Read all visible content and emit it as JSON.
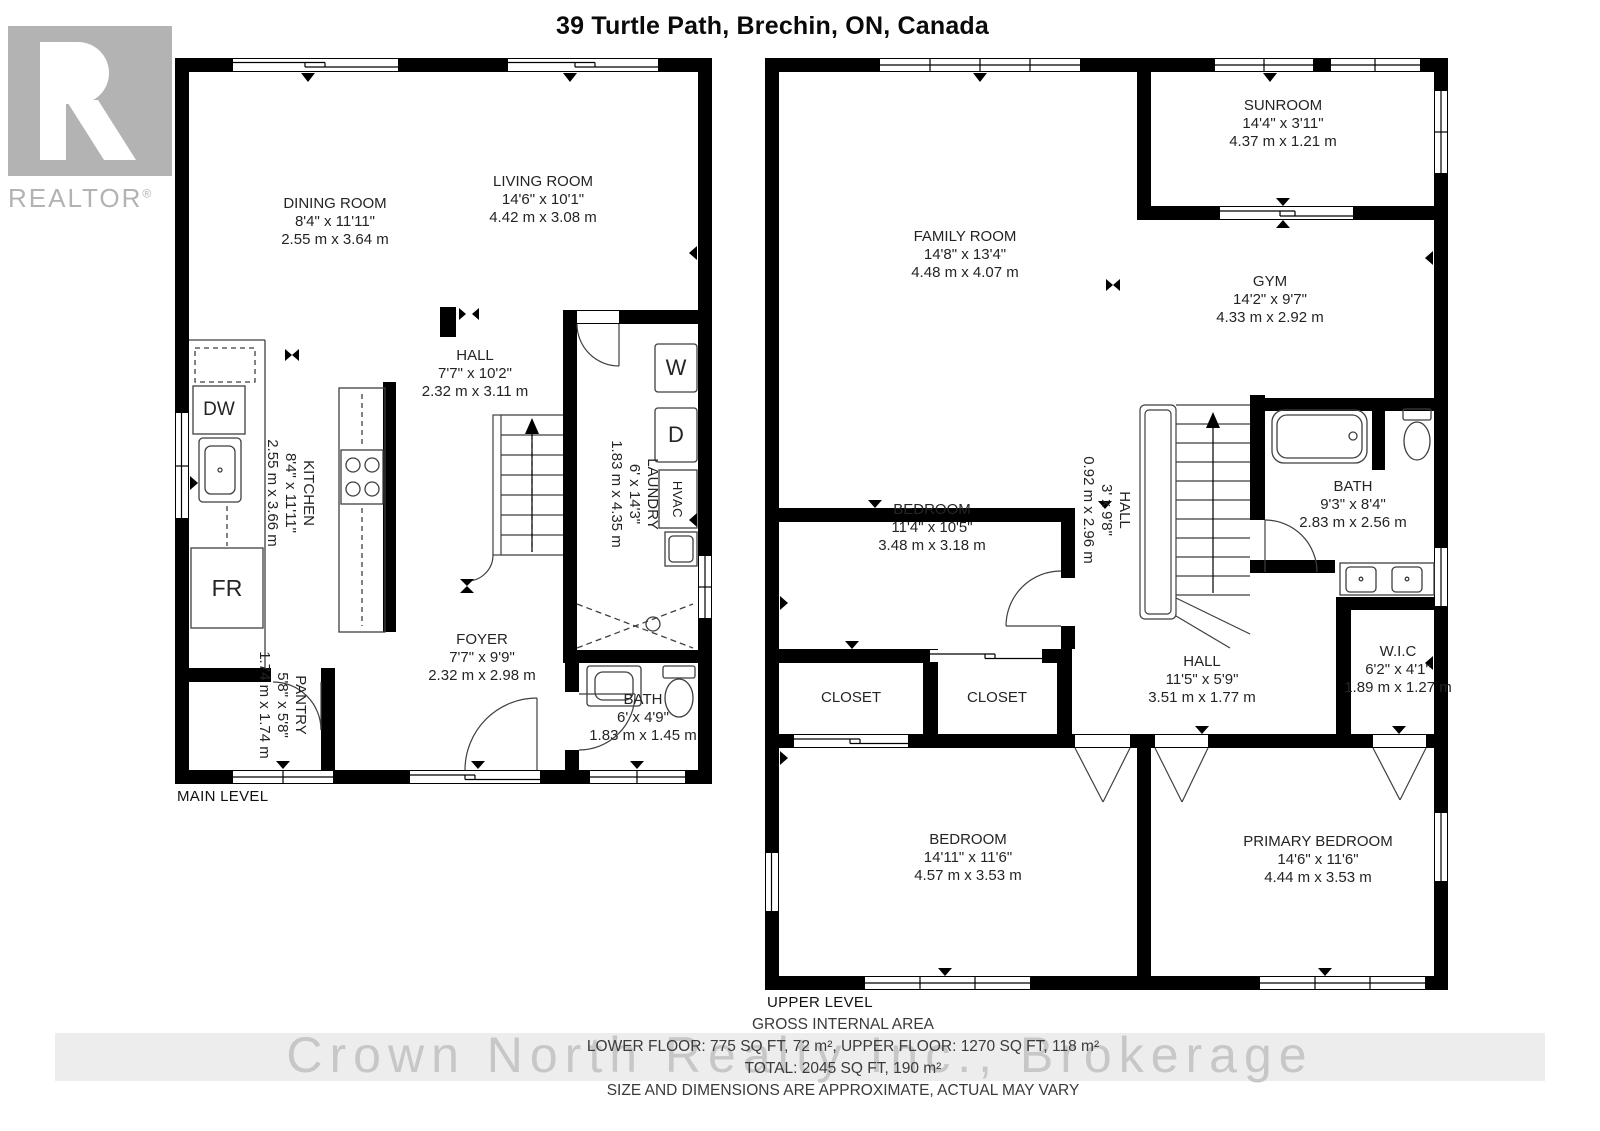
{
  "title": "39 Turtle Path, Brechin, ON, Canada",
  "logo": {
    "text": "REALTOR",
    "reg": "®"
  },
  "main": {
    "label": "MAIN LEVEL",
    "rooms": {
      "dining": {
        "name": "DINING ROOM",
        "imperial": "8'4\" x 11'11\"",
        "metric": "2.55 m x 3.64 m"
      },
      "living": {
        "name": "LIVING ROOM",
        "imperial": "14'6\" x 10'1\"",
        "metric": "4.42 m x 3.08 m"
      },
      "kitchen": {
        "name": "KITCHEN",
        "imperial": "8'4\" x 11'11\"",
        "metric": "2.55 m x 3.66 m"
      },
      "hall": {
        "name": "HALL",
        "imperial": "7'7\" x 10'2\"",
        "metric": "2.32 m x 3.11 m"
      },
      "laundry": {
        "name": "LAUNDRY",
        "imperial": "6' x 14'3\"",
        "metric": "1.83 m x 4.35 m"
      },
      "foyer": {
        "name": "FOYER",
        "imperial": "7'7\" x 9'9\"",
        "metric": "2.32 m x 2.98 m"
      },
      "bath": {
        "name": "BATH",
        "imperial": "6' x 4'9\"",
        "metric": "1.83 m x 1.45 m"
      },
      "pantry": {
        "name": "PANTRY",
        "imperial": "5'8\" x 5'8\"",
        "metric": "1.74 m x 1.74 m"
      }
    },
    "fixtures": {
      "dw": "DW",
      "fr": "FR",
      "washer": "W",
      "dryer": "D",
      "hvac": "HVAC"
    }
  },
  "upper": {
    "label": "UPPER LEVEL",
    "rooms": {
      "sunroom": {
        "name": "SUNROOM",
        "imperial": "14'4\" x 3'11\"",
        "metric": "4.37 m x 1.21 m"
      },
      "family": {
        "name": "FAMILY ROOM",
        "imperial": "14'8\" x 13'4\"",
        "metric": "4.48 m x 4.07 m"
      },
      "gym": {
        "name": "GYM",
        "imperial": "14'2\" x 9'7\"",
        "metric": "4.33 m x 2.92 m"
      },
      "bedroom": {
        "name": "BEDROOM",
        "imperial": "11'4\" x 10'5\"",
        "metric": "3.48 m x 3.18 m"
      },
      "hall_upper": {
        "name": "HALL",
        "imperial": "3' x 9'8\"",
        "metric": "0.92 m x 2.96 m"
      },
      "bath": {
        "name": "BATH",
        "imperial": "9'3\" x 8'4\"",
        "metric": "2.83 m x 2.56 m"
      },
      "closet1": {
        "name": "CLOSET"
      },
      "closet2": {
        "name": "CLOSET"
      },
      "hall": {
        "name": "HALL",
        "imperial": "11'5\" x 5'9\"",
        "metric": "3.51 m x 1.77 m"
      },
      "wic": {
        "name": "W.I.C",
        "imperial": "6'2\" x 4'1\"",
        "metric": "1.89 m x 1.27 m"
      },
      "bedroom2": {
        "name": "BEDROOM",
        "imperial": "14'11\" x 11'6\"",
        "metric": "4.57 m x 3.53 m"
      },
      "primary": {
        "name": "PRIMARY BEDROOM",
        "imperial": "14'6\" x 11'6\"",
        "metric": "4.44 m x 3.53 m"
      }
    }
  },
  "footer": {
    "watermark": "Crown North Realty Inc., Brokerage",
    "gross_title": "GROSS INTERNAL AREA",
    "floors": "LOWER FLOOR: 775 SQ FT, 72 m², UPPER FLOOR: 1270 SQ FT, 118 m²",
    "total": "TOTAL: 2045 SQ FT, 190 m²",
    "disclaimer": "SIZE AND DIMENSIONS ARE APPROXIMATE, ACTUAL MAY VARY"
  }
}
